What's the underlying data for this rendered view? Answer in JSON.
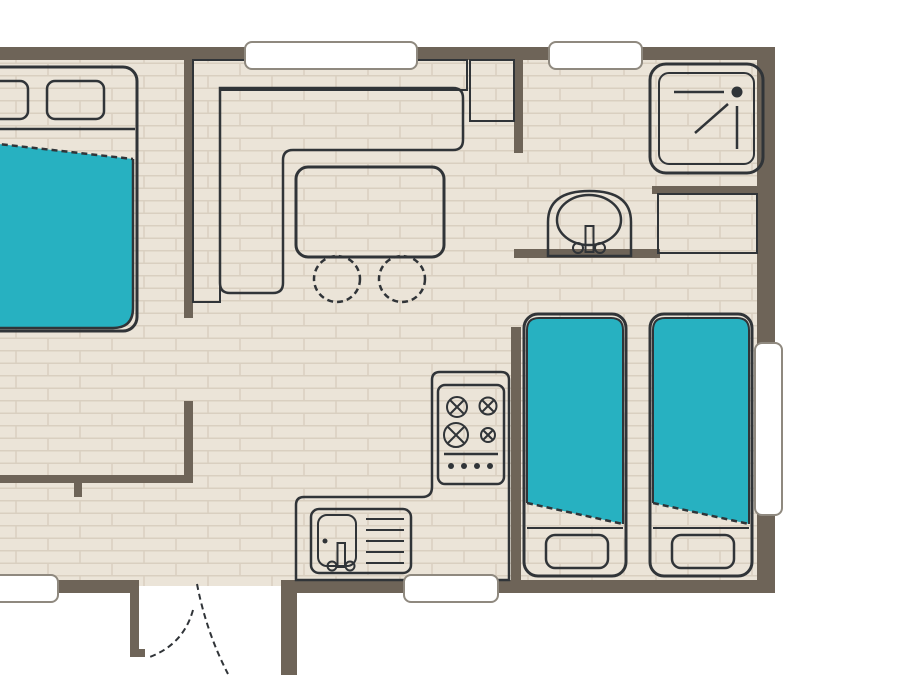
{
  "title": "mobile-home floor plan",
  "colors": {
    "wall": "#6e6458",
    "floor": "#ebe4d8",
    "floorline": "#d9cfc0",
    "teal": "#27b1c1",
    "tealLight": "#7ed0db",
    "stool": "#86d3df",
    "beige": "#c9bea7",
    "ink": "#303438",
    "winborder": "#8f897f",
    "paper": "#ffffff"
  },
  "rooms": [
    {
      "name": "master-bedroom",
      "position": "top-left"
    },
    {
      "name": "living-dining",
      "position": "top-center"
    },
    {
      "name": "bathroom",
      "position": "top-right"
    },
    {
      "name": "twin-bedroom",
      "position": "right"
    },
    {
      "name": "kitchen",
      "position": "bottom-center"
    },
    {
      "name": "entrance-hall",
      "position": "bottom-left"
    }
  ],
  "furniture": [
    {
      "name": "double-bed",
      "room": "master-bedroom"
    },
    {
      "name": "corner-sofa",
      "room": "living-dining"
    },
    {
      "name": "side-unit",
      "room": "living-dining"
    },
    {
      "name": "dining-table",
      "room": "living-dining"
    },
    {
      "name": "stool",
      "room": "living-dining",
      "count": 2
    },
    {
      "name": "shower-tray",
      "room": "bathroom"
    },
    {
      "name": "washbasin",
      "room": "bathroom"
    },
    {
      "name": "wardrobe",
      "room": "twin-bedroom"
    },
    {
      "name": "twin-bed",
      "room": "twin-bedroom",
      "count": 2
    },
    {
      "name": "kitchen-counter",
      "room": "kitchen"
    },
    {
      "name": "stove-4-burners",
      "room": "kitchen"
    },
    {
      "name": "kitchen-sink-with-drainer",
      "room": "kitchen"
    }
  ],
  "openings": [
    {
      "name": "window-top-living"
    },
    {
      "name": "window-top-bathroom"
    },
    {
      "name": "window-bottom-left"
    },
    {
      "name": "window-bottom-kitchen"
    },
    {
      "name": "window-right-twin-bedroom"
    },
    {
      "name": "entrance-double-door-swing"
    }
  ]
}
